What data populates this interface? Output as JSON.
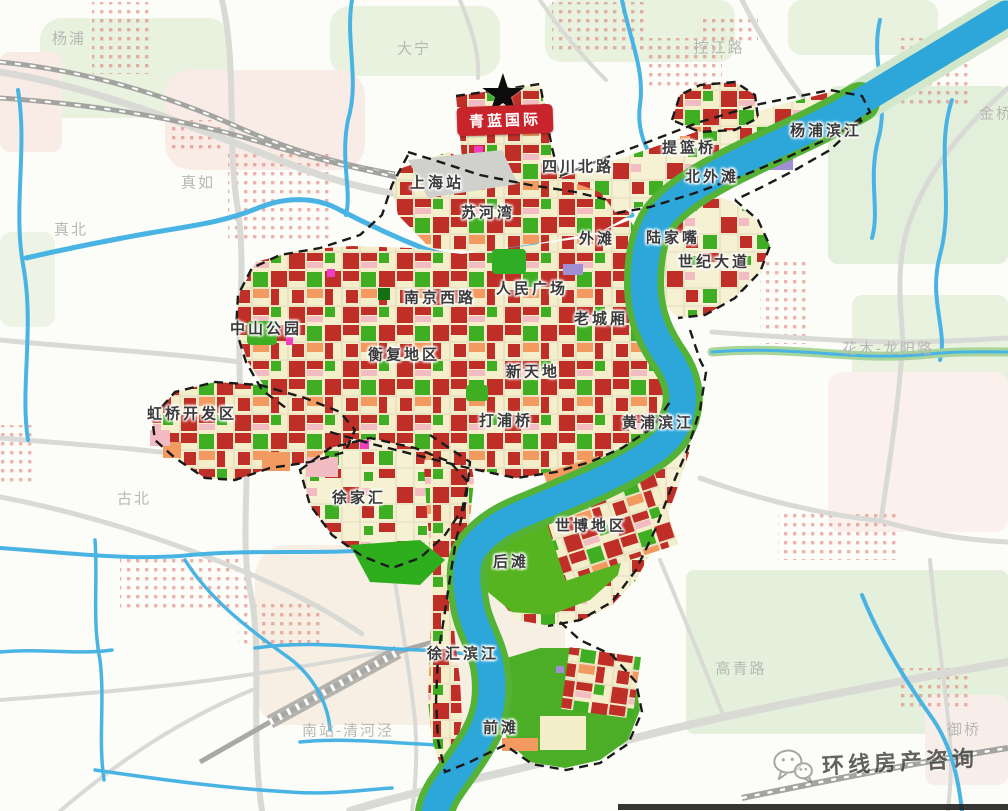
{
  "map": {
    "marker": {
      "label": "青蓝国际",
      "star_glyph": "★",
      "bg_color": "#c9232b",
      "text_color": "#ffffff"
    },
    "watermark": {
      "text": "环线房产咨询",
      "icon": "wechat-icon"
    },
    "district_labels": [
      {
        "text": "上海站",
        "x": 437,
        "y": 182
      },
      {
        "text": "四川北路",
        "x": 578,
        "y": 166
      },
      {
        "text": "苏河湾",
        "x": 488,
        "y": 212
      },
      {
        "text": "外滩",
        "x": 597,
        "y": 238
      },
      {
        "text": "陆家嘴",
        "x": 673,
        "y": 237
      },
      {
        "text": "世纪大道",
        "x": 714,
        "y": 261
      },
      {
        "text": "北外滩",
        "x": 712,
        "y": 176
      },
      {
        "text": "提篮桥",
        "x": 689,
        "y": 147
      },
      {
        "text": "杨浦滨江",
        "x": 826,
        "y": 130
      },
      {
        "text": "南京西路",
        "x": 440,
        "y": 297
      },
      {
        "text": "人民广场",
        "x": 532,
        "y": 288
      },
      {
        "text": "老城厢",
        "x": 601,
        "y": 318
      },
      {
        "text": "中山公园",
        "x": 266,
        "y": 328
      },
      {
        "text": "衡复地区",
        "x": 404,
        "y": 354
      },
      {
        "text": "新天地",
        "x": 533,
        "y": 371
      },
      {
        "text": "打浦桥",
        "x": 506,
        "y": 420
      },
      {
        "text": "黄浦滨江",
        "x": 658,
        "y": 422
      },
      {
        "text": "虹桥开发区",
        "x": 192,
        "y": 413
      },
      {
        "text": "徐家汇",
        "x": 359,
        "y": 497
      },
      {
        "text": "世博地区",
        "x": 591,
        "y": 525
      },
      {
        "text": "后滩",
        "x": 511,
        "y": 561
      },
      {
        "text": "徐汇滨江",
        "x": 463,
        "y": 653
      },
      {
        "text": "前滩",
        "x": 501,
        "y": 727
      }
    ],
    "faded_labels": [
      {
        "text": "杨浦",
        "x": 69,
        "y": 38
      },
      {
        "text": "大宁",
        "x": 414,
        "y": 48
      },
      {
        "text": "控江路",
        "x": 719,
        "y": 47
      },
      {
        "text": "真如",
        "x": 198,
        "y": 182
      },
      {
        "text": "真北",
        "x": 71,
        "y": 229
      },
      {
        "text": "古北",
        "x": 134,
        "y": 498
      },
      {
        "text": "花木-龙阳路",
        "x": 888,
        "y": 348
      },
      {
        "text": "金桥",
        "x": 996,
        "y": 113
      },
      {
        "text": "高青路",
        "x": 741,
        "y": 668
      },
      {
        "text": "南站-清河泾",
        "x": 348,
        "y": 730
      },
      {
        "text": "御桥",
        "x": 964,
        "y": 729
      }
    ],
    "colors": {
      "background": "#fcfcf9",
      "pale_green": "#e8f2df",
      "pale_pink": "#f9ece7",
      "river": "#2da7d9",
      "stream": "#49b4e4",
      "river_bank_green": "#54b237",
      "parcel_cream": "#f4eecb",
      "parcel_red": "#bf2f27",
      "parcel_green": "#3fae22",
      "parcel_orange": "#f29a60",
      "parcel_pink": "#f3bcc2",
      "parcel_magenta": "#ef3fc0",
      "parcel_purple": "#a08fd2",
      "road": "#d9d9d5",
      "railway": "#a3a3a0",
      "boundary": "#1a1a1a"
    }
  }
}
